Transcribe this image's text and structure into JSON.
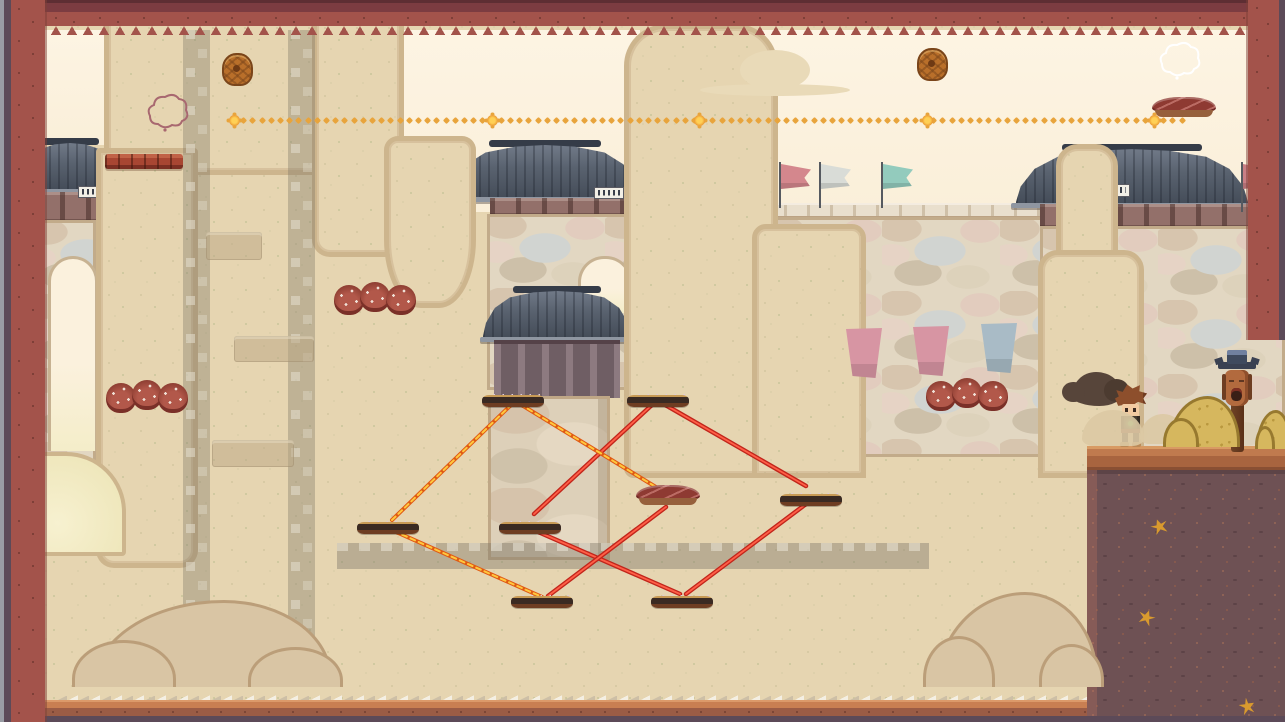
{
  "meta": {
    "scene_label": "pixel-art platformer level - desert fortress with Korean gate towers",
    "visible_text": "none (decorative illegible plaque glyphs only)"
  },
  "palette": {
    "sky": "#fdf4e3",
    "sand": "#e6d5b1",
    "sand_edge": "#cdb58d",
    "border_red": "#a3534b",
    "border_dark": "#5c4a58",
    "roof": "#59626f",
    "stone": "#e2d7c2",
    "laser_red": "#c1251b",
    "laser_red_core": "#ff5f47",
    "laser_flame": "#e05a14",
    "laser_flame_core": "#ffc83e",
    "star_gold": "#e8a43c",
    "dirt": "#6e5154",
    "soil": "#b5714b",
    "spike_platform_base": "#3a2a22",
    "spike_color": "#dccadc",
    "meat_platform": "#8e3a32"
  },
  "player": {
    "x": 1114,
    "y": 384,
    "state": "standing",
    "facing": "left"
  },
  "totem_pole": {
    "x": 1218,
    "y": 350
  },
  "smoke_puff": [
    1072,
    372,
    50,
    34
  ],
  "collectible_trail": {
    "y": 118,
    "x_start": 232,
    "x_end": 1188,
    "spacing": 9.2,
    "big_marker_xs": [
      232,
      490,
      697,
      925,
      1152
    ]
  },
  "acorn_pickups": [
    {
      "x": 222,
      "y": 53
    },
    {
      "x": 917,
      "y": 48
    }
  ],
  "spike_platforms": [
    {
      "id": "A",
      "x": 482,
      "y": 386
    },
    {
      "id": "B",
      "x": 627,
      "y": 386
    },
    {
      "id": "C",
      "x": 357,
      "y": 513
    },
    {
      "id": "D",
      "x": 499,
      "y": 513
    },
    {
      "id": "E",
      "x": 780,
      "y": 485
    },
    {
      "id": "F",
      "x": 651,
      "y": 587
    },
    {
      "id": "G",
      "x": 511,
      "y": 587
    }
  ],
  "meat_platforms": [
    {
      "x": 636,
      "y": 485
    },
    {
      "x": 1152,
      "y": 97
    }
  ],
  "laser_links": {
    "flame": [
      [
        512,
        404,
        392,
        520
      ],
      [
        394,
        531,
        542,
        597
      ],
      [
        520,
        404,
        664,
        492
      ]
    ],
    "red": [
      [
        654,
        403,
        534,
        514
      ],
      [
        662,
        403,
        806,
        486
      ],
      [
        536,
        531,
        680,
        594
      ],
      [
        806,
        504,
        686,
        594
      ],
      [
        666,
        507,
        548,
        596
      ]
    ]
  },
  "ladders": [
    {
      "x": 183
    },
    {
      "x": 288
    }
  ],
  "ladder_shelves": [
    [
      206,
      232,
      56,
      28
    ],
    [
      234,
      336,
      80,
      26
    ],
    [
      212,
      440,
      82,
      27
    ]
  ],
  "glass_beam": [
    337,
    543,
    592,
    26
  ],
  "flags_on_wall": [
    {
      "x": 779,
      "color": "#d4878d"
    },
    {
      "x": 819,
      "color": "#d9dcd7"
    },
    {
      "x": 881,
      "color": "#93cbbd"
    }
  ],
  "gate_flag": {
    "x": 1241,
    "y": 162,
    "color": "#c97f85"
  },
  "banners": [
    {
      "x": 846,
      "y": 328,
      "color": "#d795a3"
    },
    {
      "x": 913,
      "y": 326,
      "color": "#d795a3"
    },
    {
      "x": 981,
      "y": 323,
      "color": "#a9bbc6"
    }
  ],
  "red_plants": [
    {
      "x": 106,
      "y": 383
    },
    {
      "x": 334,
      "y": 285
    },
    {
      "x": 926,
      "y": 381
    }
  ],
  "gold_leaves": [
    {
      "x": 1151,
      "y": 519
    },
    {
      "x": 1138,
      "y": 610
    },
    {
      "x": 1239,
      "y": 699
    }
  ],
  "outline_clouds": [
    {
      "x": 146,
      "y": 92,
      "color": "#a86870"
    },
    {
      "x": 1158,
      "y": 40,
      "color": "#ffffff"
    }
  ],
  "tan_clouds": [
    [
      740,
      50,
      70,
      40
    ],
    [
      700,
      84,
      150,
      12
    ]
  ],
  "mounds": [
    [
      92,
      600,
      234,
      84
    ],
    [
      936,
      592,
      156,
      92
    ]
  ],
  "dust_puffs": [
    [
      1082,
      410,
      62,
      36
    ],
    [
      1140,
      414,
      46,
      30
    ]
  ],
  "yellow_bushes": [
    [
      1168,
      396,
      66,
      48
    ],
    [
      1256,
      410,
      30,
      36
    ]
  ]
}
